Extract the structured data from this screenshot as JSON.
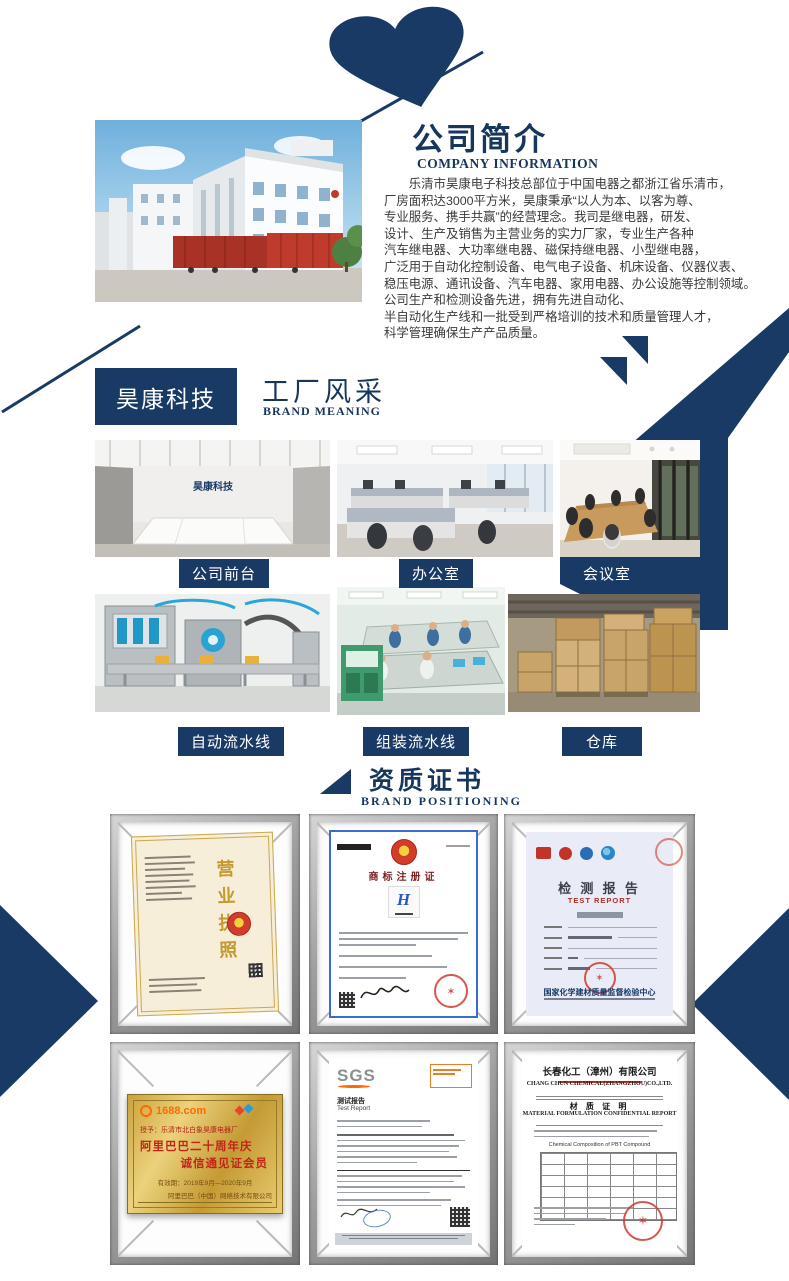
{
  "page": {
    "background": "#ffffff",
    "accent_navy": "#1a3a66",
    "heading_navy": "#16365c"
  },
  "intro": {
    "title": "公司简介",
    "subtitle": "COMPANY INFORMATION",
    "paragraph": "　　乐清市昊康电子科技总部位于中国电器之都浙江省乐清市，\n厂房面积达3000平方米，昊康秉承“以人为本、以客为尊、\n专业服务、携手共赢”的经营理念。我司是继电器，研发、\n设计、生产及销售为主营业务的实力厂家，专业生产各种\n汽车继电器、大功率继电器、磁保持继电器、小型继电器，\n广泛用于自动化控制设备、电气电子设备、机床设备、仪器仪表、\n稳压电源、通讯设备、汽车电器、家用电器、办公设施等控制领域。\n公司生产和检测设备先进，拥有先进自动化、\n半自动化生产线和一批受到严格培训的技术和质量管理人才，\n科学管理确保生产产品质量。"
  },
  "factory": {
    "badge": "昊康科技",
    "title": "工厂风采",
    "subtitle": "BRAND MEANING",
    "reception_wall_text": "昊康科技",
    "photos": [
      {
        "label": "公司前台"
      },
      {
        "label": "办公室"
      },
      {
        "label": "会议室"
      },
      {
        "label": "自动流水线"
      },
      {
        "label": "组装流水线"
      },
      {
        "label": "仓库"
      }
    ]
  },
  "certs": {
    "title": "资质证书",
    "subtitle": "BRAND POSITIONING",
    "business_license": {
      "title": "营业执照"
    },
    "trademark": {
      "title": "商标注册证",
      "logo_letter": "H"
    },
    "test_report": {
      "title_cn": "检 测 报 告",
      "title_en": "TEST REPORT",
      "issuer": "国家化学建材质量监督检验中心"
    },
    "plaque": {
      "site": "1688.com",
      "awarded": "授予：乐清市北白象昊康电器厂",
      "line1": "阿里巴巴二十周年庆",
      "line2": "诚信通见证会员",
      "validity": "有效期：2019年9月—2020年9月",
      "company": "阿里巴巴（中国）网络技术有限公司"
    },
    "sgs": {
      "logo": "SGS",
      "title_cn": "测试报告",
      "title_en": "Test Report"
    },
    "material": {
      "company_cn": "长春化工（漳州）有限公司",
      "company_en": "CHANG CHUN CHEMICAL(ZHANGZHOU)CO.,LTD.",
      "title_cn": "材 质 证 明",
      "title_en": "MATERIAL FORMULATION CONFIDENTIAL REPORT",
      "table_caption": "Chemical Composition of PBT Compound"
    }
  }
}
